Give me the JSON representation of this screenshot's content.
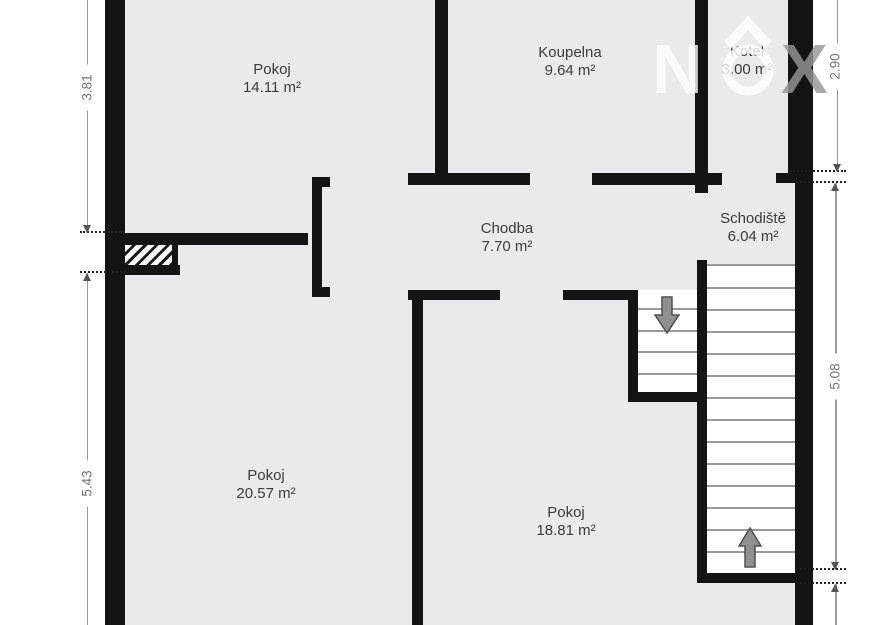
{
  "floorplan": {
    "rooms": [
      {
        "name": "Pokoj",
        "area": "14.11 m²"
      },
      {
        "name": "Koupelna",
        "area": "9.64 m²"
      },
      {
        "name": "Kotel",
        "area": "3.00 m²"
      },
      {
        "name": "Chodba",
        "area": "7.70 m²"
      },
      {
        "name": "Schodiště",
        "area": "6.04 m²"
      },
      {
        "name": "Pokoj",
        "area": "20.57 m²"
      },
      {
        "name": "Pokoj",
        "area": "18.81 m²"
      }
    ],
    "dimensions": {
      "left_top": "3.81",
      "left_bottom": "5.43",
      "right_top": "2.90",
      "right_middle": "5.08"
    },
    "watermark": {
      "letter_n": "N",
      "letter_x": "X"
    },
    "stairs": {
      "main_flight_treads": 13,
      "small_flight_treads": 4
    },
    "colors": {
      "wall": "#141414",
      "floor": "#eaeaec",
      "outside": "#ffffff",
      "tread_line": "#9a9a9a",
      "dimension_text": "#757575",
      "stair_arrow_fill": "#8f8f8f"
    }
  }
}
